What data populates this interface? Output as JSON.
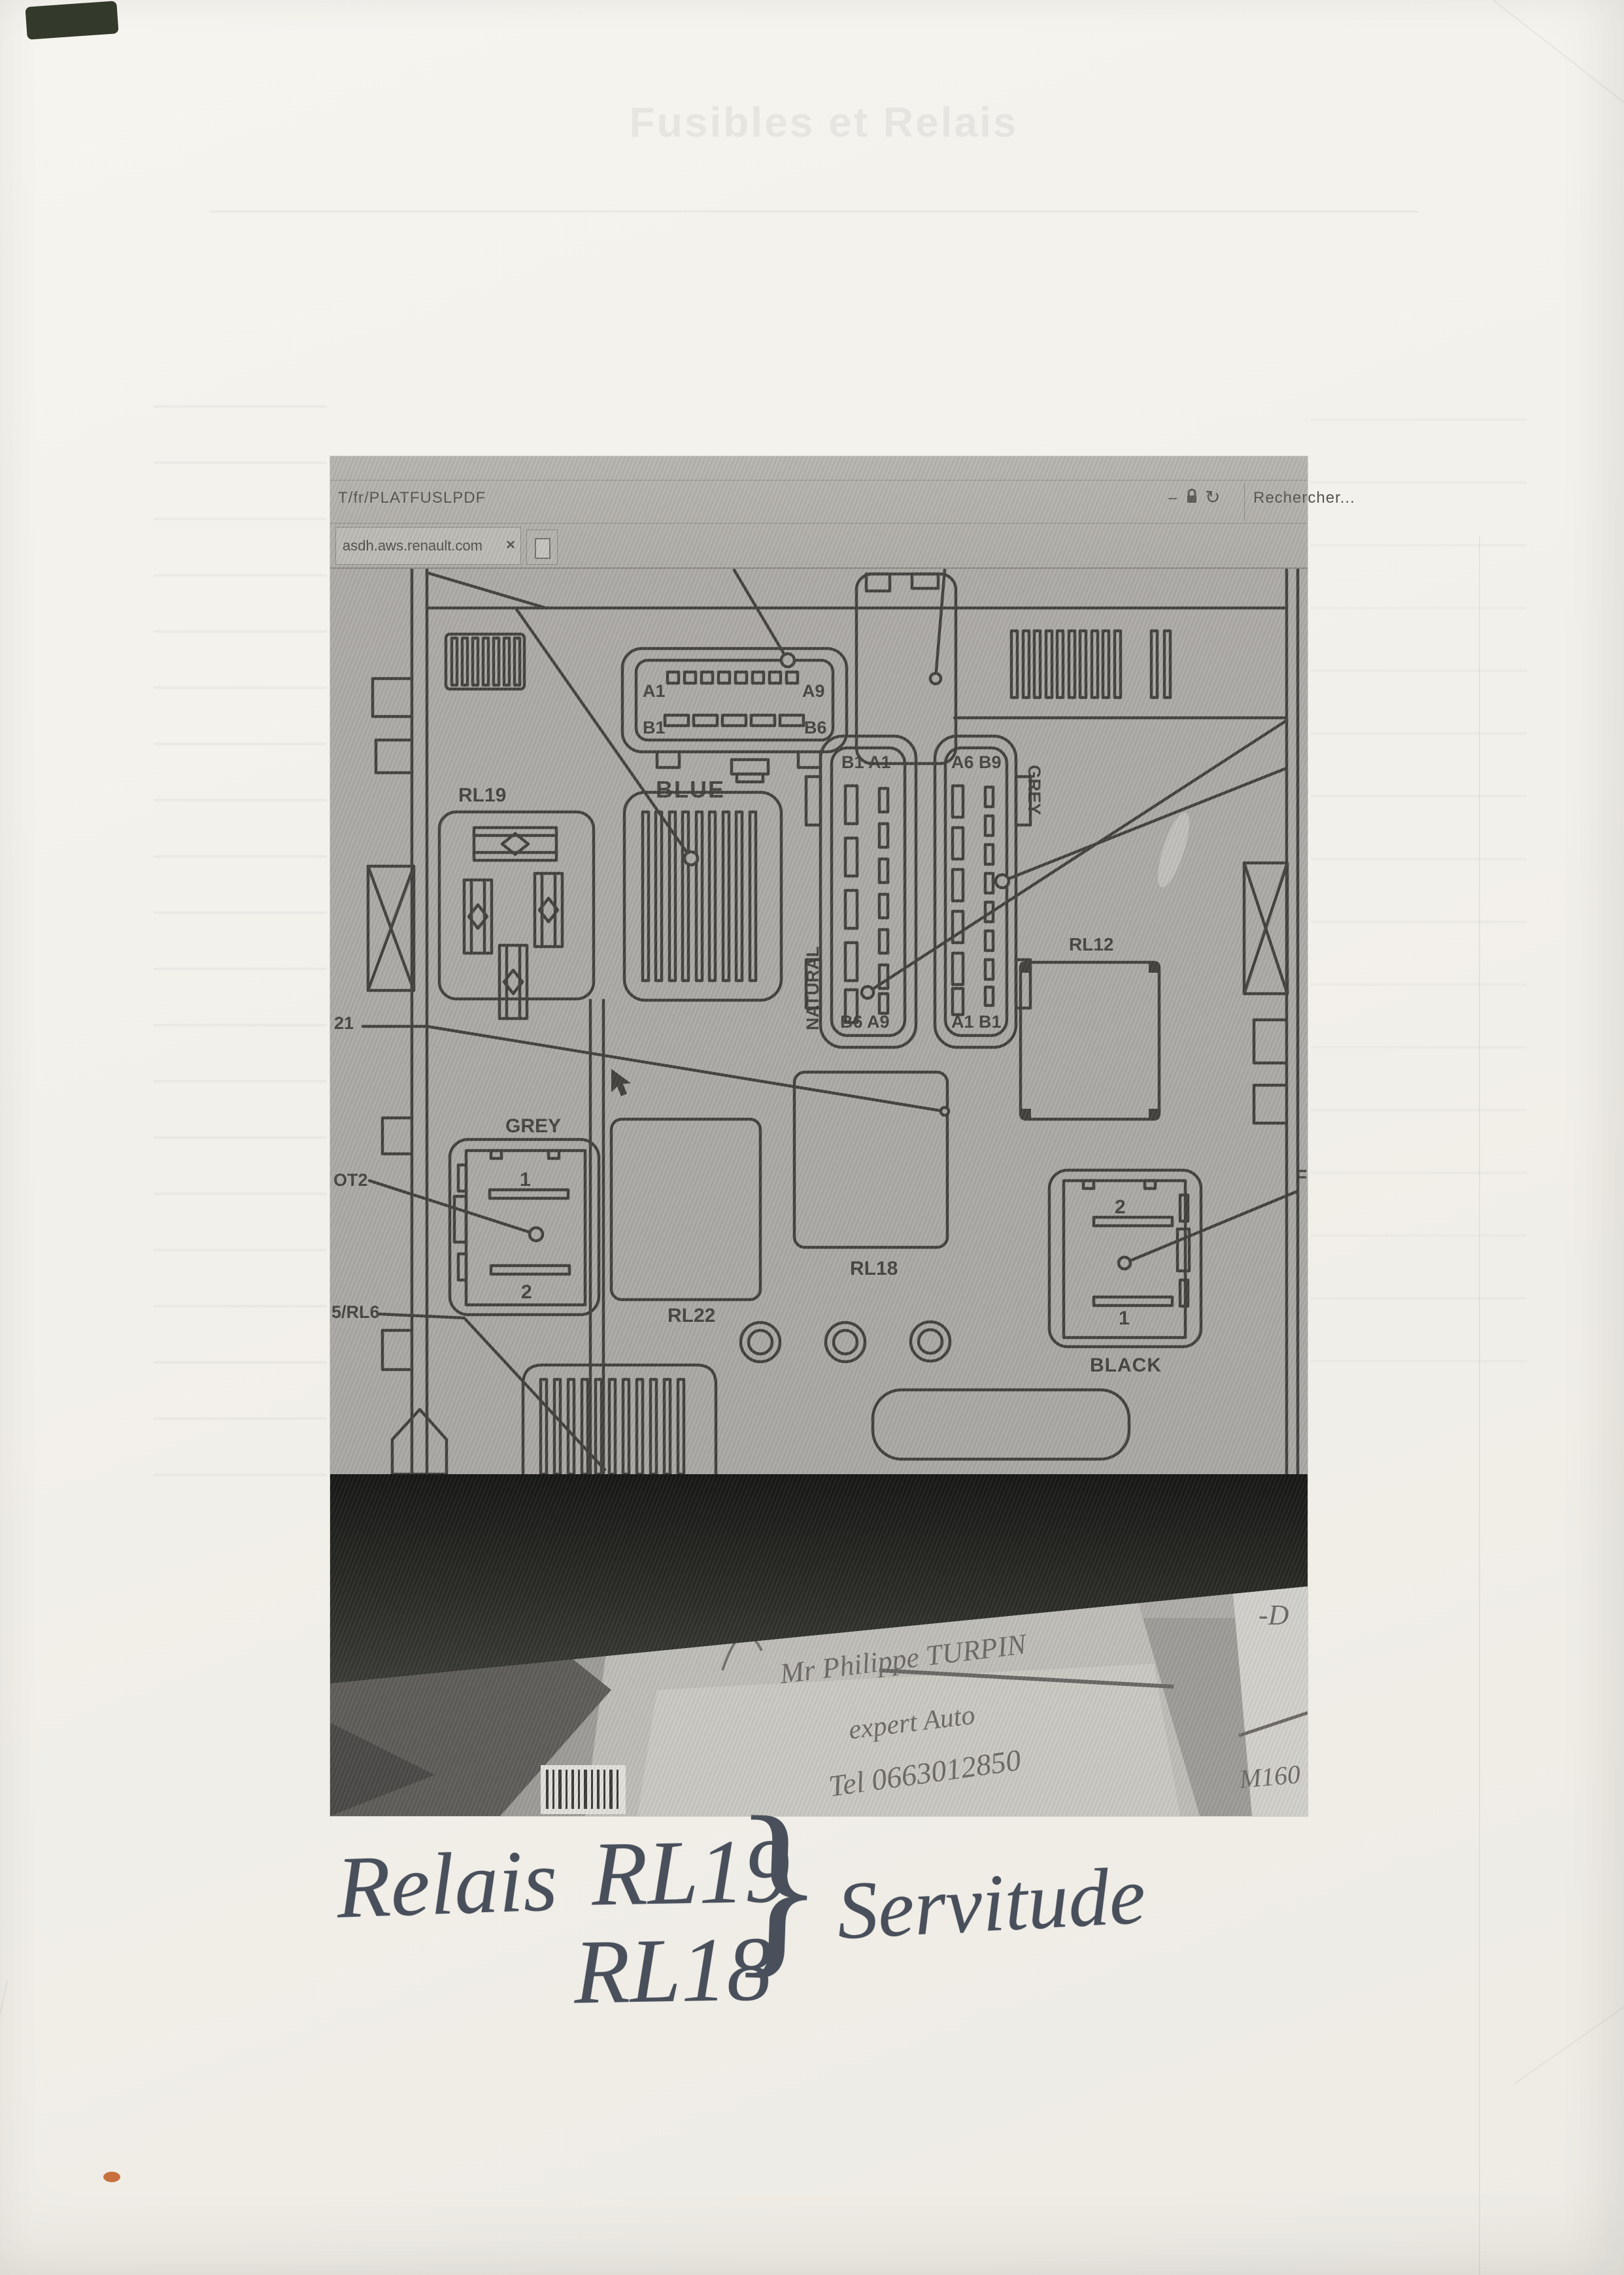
{
  "ghost": {
    "title": "Fusibles et Relais"
  },
  "browser": {
    "url_fragment": "T/fr/PLATFUSLPDF",
    "tab_title": "asdh.aws.renault.com",
    "tab_close": "×",
    "search_label": "Rechercher...",
    "minimize_glyph": "–",
    "refresh_glyph": "↻"
  },
  "diagram": {
    "blue": {
      "name": "BLUE",
      "a1": "A1",
      "a9": "A9",
      "b1": "B1",
      "b6": "B6"
    },
    "natural": {
      "name": "NATURAL",
      "top": "B1 A1",
      "bottom": "B6 A9"
    },
    "grey_conn": {
      "name": "GREY",
      "top": "A6 B9",
      "bottom": "A1 B1"
    },
    "rl19": "RL19",
    "rl12": "RL12",
    "rl18": "RL18",
    "rl22": "RL22",
    "grey_relay": {
      "name": "GREY",
      "pin1": "1",
      "pin2": "2"
    },
    "black_relay": {
      "name": "BLACK",
      "pin2": "2",
      "pin1": "1",
      "partial": "F"
    },
    "rl5_rl6": "5/RL6",
    "ot2": "OT2",
    "rl21": "21"
  },
  "photo_note": {
    "line1": "Mr Philippe TURPIN",
    "line2": "expert Auto",
    "line3": "Tel 0663012850",
    "mark_right_top": "-D",
    "mark_right_bottom": "M160"
  },
  "annotation": {
    "relais": "Relais",
    "rl19": "RL19",
    "rl18": "RL18",
    "brace": "}",
    "servitude": "Servitude"
  }
}
